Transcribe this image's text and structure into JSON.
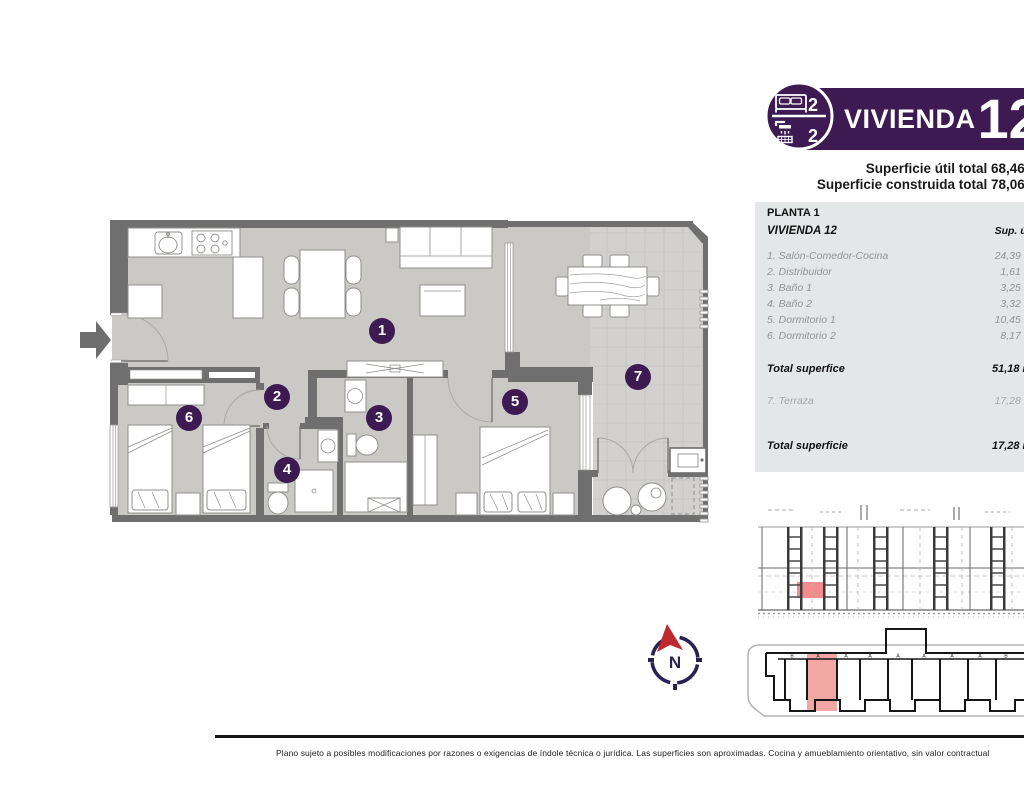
{
  "header": {
    "unit_title": "VIVIENDA",
    "unit_number": "12",
    "bedrooms_count": "2",
    "bathrooms_count": "2",
    "superficie_util": "Superficie útil total 68,46 m²",
    "superficie_construida": "Superficie construida total 78,06 m²",
    "banner_color": "#3e1a52"
  },
  "table": {
    "floor_label": "PLANTA 1",
    "unit_label": "VIVIENDA 12",
    "col_header": "Sup. útil",
    "rows": [
      {
        "number": "1",
        "label": "1. Salón-Comedor-Cocina",
        "area": "24,39 m²"
      },
      {
        "number": "2",
        "label": "2. Distribuidor",
        "area": "1,61 m²"
      },
      {
        "number": "3",
        "label": "3. Baño 1",
        "area": "3,25 m²"
      },
      {
        "number": "4",
        "label": "4. Baño 2",
        "area": "3,32 m²"
      },
      {
        "number": "5",
        "label": "5. Dormitorio 1",
        "area": "10,45 m²"
      },
      {
        "number": "6",
        "label": "6. Dormitorio 2",
        "area": "8,17 m²"
      }
    ],
    "total1": {
      "label": "Total superfice",
      "value": "51,18 m²"
    },
    "terraza": {
      "label": "7. Terraza",
      "value": "17,28 m²"
    },
    "total2": {
      "label": "Total superficie",
      "value": "17,28 m²"
    },
    "background_color": "#e4e7e7"
  },
  "plan": {
    "room_numbers": [
      "1",
      "2",
      "3",
      "4",
      "5",
      "6",
      "7"
    ],
    "compass_letter": "N",
    "colors": {
      "walls": "#6f6f6f",
      "floor": "#cac9c6",
      "terrace_floor": "#d2d1cf",
      "badge_purple": "#3e1a52",
      "compass_navy": "#2b2052",
      "compass_red": "#c1272e"
    }
  },
  "site_plan": {
    "bay_letters": [
      "B",
      "A",
      "A",
      "A",
      "A",
      "A",
      "A",
      "A",
      "B"
    ],
    "highlight_color": "#f3a7a5"
  },
  "elevation": {
    "highlight_color": "#f28080"
  },
  "footer": {
    "disclaimer": "Plano sujeto a posibles modificaciones por razones o exigencias de índole técnica o jurídica. Las superficies son aproximadas. Cocina y amueblamiento orientativo, sin valor contractual"
  }
}
